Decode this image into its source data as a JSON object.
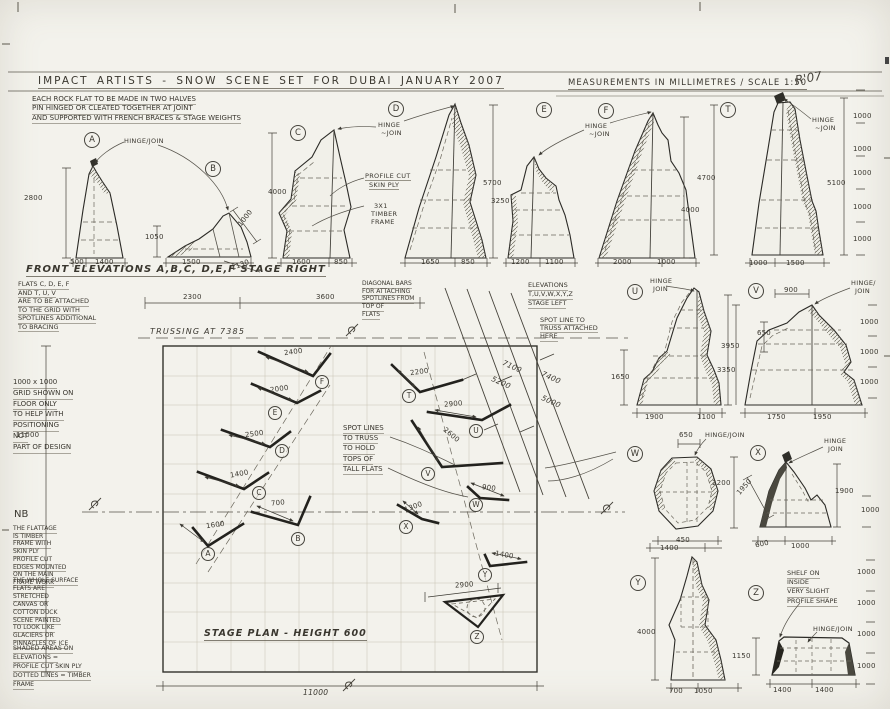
{
  "title": {
    "left": "IMPACT ARTISTS  -  SNOW SCENE SET FOR DUBAI JANUARY 2007",
    "right": "MEASUREMENTS IN MILLIMETRES / SCALE 1:50",
    "signature": "R'07"
  },
  "notes": {
    "construction": [
      "EACH ROCK FLAT TO BE MADE IN TWO HALVES",
      "PIN HINGED OR CLEATED TOGETHER AT JOINT",
      "AND SUPPORTED WITH FRENCH BRACES & STAGE WEIGHTS"
    ],
    "front_elevations": "FRONT ELEVATIONS A,B,C, D,E,F  STAGE RIGHT",
    "flats_attach": [
      "FLATS C, D, E, F",
      "AND T, U, V",
      "ARE TO BE ATTACHED",
      "TO THE GRID WITH",
      "SPOTLINES ADDITIONAL",
      "TO BRACING"
    ],
    "grid_note": [
      "1000 x 1000",
      "GRID SHOWN ON",
      "FLOOR ONLY",
      "TO HELP WITH",
      "POSITIONING",
      "NOT",
      "PART OF DESIGN"
    ],
    "nb_title": "NB",
    "nb1": [
      "THE FLATTAGE",
      "IS TIMBER",
      "FRAME WITH",
      "SKIN PLY",
      "PROFILE CUT",
      "EDGES MOUNTED",
      "ON THE MAIN",
      "FRAME WORK"
    ],
    "nb2": [
      "THE WHOLE SURFACE",
      "FLATS ARE",
      "STRETCHED",
      "CANVAS OR",
      "COTTON DUCK",
      "SCENE PAINTED",
      "TO LOOK LIKE",
      "GLACIERS OR",
      "PINNACLES OF ICE"
    ],
    "nb3": [
      "SHADED AREAS ON",
      "ELEVATIONS =",
      "PROFILE CUT SKIN PLY",
      "DOTTED LINES = TIMBER",
      "FRAME"
    ],
    "diagonal_bars": [
      "DIAGONAL BARS",
      "FOR ATTACHING",
      "SPOTLINES FROM",
      "TOP OF",
      "FLATS"
    ],
    "elevations_left": [
      "ELEVATIONS",
      "T,U,V,W,X,Y,Z",
      "STAGE LEFT"
    ],
    "spot_line": [
      "SPOT LINE TO",
      "TRUSS ATTACHED",
      "HERE"
    ],
    "spot_lines_truss": [
      "SPOT LINES",
      "TO TRUSS",
      "TO HOLD",
      "TOPS OF",
      "TALL FLATS"
    ],
    "trussing": "TRUSSING AT 7385",
    "stage_plan": "STAGE PLAN  -  HEIGHT 600",
    "shelf": [
      "SHELF ON",
      "INSIDE",
      "VERY SLIGHT",
      "PROFILE SHAPE"
    ]
  },
  "annotations": [
    {
      "n": "elev-label-a",
      "t": "A",
      "x": 84,
      "y": 132,
      "c": "circ"
    },
    {
      "n": "elev-label-b",
      "t": "B",
      "x": 205,
      "y": 161,
      "c": "circ"
    },
    {
      "n": "elev-label-c",
      "t": "C",
      "x": 290,
      "y": 125,
      "c": "circ"
    },
    {
      "n": "elev-label-d",
      "t": "D",
      "x": 388,
      "y": 101,
      "c": "circ"
    },
    {
      "n": "elev-label-e",
      "t": "E",
      "x": 536,
      "y": 102,
      "c": "circ"
    },
    {
      "n": "elev-label-f",
      "t": "F",
      "x": 598,
      "y": 103,
      "c": "circ"
    },
    {
      "n": "elev-label-t",
      "t": "T",
      "x": 720,
      "y": 102,
      "c": "circ"
    },
    {
      "n": "elev-label-u",
      "t": "U",
      "x": 627,
      "y": 284,
      "c": "circ"
    },
    {
      "n": "elev-label-v",
      "t": "V",
      "x": 748,
      "y": 283,
      "c": "circ"
    },
    {
      "n": "elev-label-w",
      "t": "W",
      "x": 627,
      "y": 446,
      "c": "circ"
    },
    {
      "n": "elev-label-x",
      "t": "X",
      "x": 750,
      "y": 445,
      "c": "circ"
    },
    {
      "n": "elev-label-y",
      "t": "Y",
      "x": 630,
      "y": 575,
      "c": "circ"
    },
    {
      "n": "elev-label-z",
      "t": "Z",
      "x": 748,
      "y": 585,
      "c": "circ"
    },
    {
      "n": "plan-label-f",
      "t": "F",
      "x": 315,
      "y": 375,
      "c": "circ-sm"
    },
    {
      "n": "plan-label-e",
      "t": "E",
      "x": 268,
      "y": 406,
      "c": "circ-sm"
    },
    {
      "n": "plan-label-d",
      "t": "D",
      "x": 275,
      "y": 444,
      "c": "circ-sm"
    },
    {
      "n": "plan-label-c",
      "t": "C",
      "x": 252,
      "y": 486,
      "c": "circ-sm"
    },
    {
      "n": "plan-label-a",
      "t": "A",
      "x": 201,
      "y": 547,
      "c": "circ-sm"
    },
    {
      "n": "plan-label-b",
      "t": "B",
      "x": 291,
      "y": 532,
      "c": "circ-sm"
    },
    {
      "n": "plan-label-t",
      "t": "T",
      "x": 402,
      "y": 389,
      "c": "circ-sm"
    },
    {
      "n": "plan-label-u",
      "t": "U",
      "x": 469,
      "y": 424,
      "c": "circ-sm"
    },
    {
      "n": "plan-label-v",
      "t": "V",
      "x": 421,
      "y": 467,
      "c": "circ-sm"
    },
    {
      "n": "plan-label-w",
      "t": "W",
      "x": 469,
      "y": 498,
      "c": "circ-sm"
    },
    {
      "n": "plan-label-x",
      "t": "X",
      "x": 399,
      "y": 520,
      "c": "circ-sm"
    },
    {
      "n": "plan-label-y",
      "t": "Y",
      "x": 478,
      "y": 568,
      "c": "circ-sm"
    },
    {
      "n": "plan-label-z",
      "t": "Z",
      "x": 470,
      "y": 630,
      "c": "circ-sm"
    },
    {
      "n": "hinge-label-ab",
      "t": "HINGE/JOIN",
      "x": 124,
      "y": 137,
      "c": "hand"
    },
    {
      "n": "hinge-label-cd-1",
      "t": "HINGE",
      "x": 378,
      "y": 121,
      "c": "hand"
    },
    {
      "n": "hinge-label-cd-2",
      "t": "~JOIN",
      "x": 381,
      "y": 129,
      "c": "hand"
    },
    {
      "n": "hinge-label-ef-1",
      "t": "HINGE",
      "x": 585,
      "y": 122,
      "c": "hand"
    },
    {
      "n": "hinge-label-ef-2",
      "t": "~JOIN",
      "x": 589,
      "y": 130,
      "c": "hand"
    },
    {
      "n": "hinge-label-t-1",
      "t": "HINGE",
      "x": 812,
      "y": 116,
      "c": "hand"
    },
    {
      "n": "hinge-label-t-2",
      "t": "~JOIN",
      "x": 815,
      "y": 124,
      "c": "hand"
    },
    {
      "n": "hinge-label-u-1",
      "t": "HINGE",
      "x": 650,
      "y": 277,
      "c": "hand"
    },
    {
      "n": "hinge-label-u-2",
      "t": "JOIN",
      "x": 653,
      "y": 285,
      "c": "hand"
    },
    {
      "n": "hinge-label-v-1",
      "t": "HINGE/",
      "x": 851,
      "y": 279,
      "c": "hand"
    },
    {
      "n": "hinge-label-v-2",
      "t": "JOIN",
      "x": 855,
      "y": 287,
      "c": "hand"
    },
    {
      "n": "hinge-label-w",
      "t": "HINGE/JOIN",
      "x": 705,
      "y": 431,
      "c": "hand"
    },
    {
      "n": "hinge-label-x-1",
      "t": "HINGE",
      "x": 824,
      "y": 437,
      "c": "hand"
    },
    {
      "n": "hinge-label-x-2",
      "t": "JOIN",
      "x": 828,
      "y": 445,
      "c": "hand"
    },
    {
      "n": "hinge-label-z",
      "t": "HINGE/JOIN",
      "x": 813,
      "y": 625,
      "c": "hand"
    },
    {
      "n": "profile-cut-label-1",
      "t": "PROFILE CUT",
      "x": 365,
      "y": 172,
      "c": "hand-ul"
    },
    {
      "n": "profile-cut-label-2",
      "t": "SKIN PLY",
      "x": 369,
      "y": 181,
      "c": "hand-ul"
    },
    {
      "n": "timber-label-1",
      "t": "3X1",
      "x": 374,
      "y": 202,
      "c": "hand"
    },
    {
      "n": "timber-label-2",
      "t": "TIMBER",
      "x": 371,
      "y": 210,
      "c": "hand"
    },
    {
      "n": "timber-label-3",
      "t": "FRAME",
      "x": 371,
      "y": 218,
      "c": "hand"
    },
    {
      "n": "dim-a-height",
      "t": "2800",
      "x": 24,
      "y": 194,
      "c": "dim"
    },
    {
      "n": "dim-a-base1",
      "t": "500",
      "x": 70,
      "y": 258,
      "c": "dim"
    },
    {
      "n": "dim-a-base2",
      "t": "1400",
      "x": 95,
      "y": 258,
      "c": "dim"
    },
    {
      "n": "dim-b-height",
      "t": "1050",
      "x": 145,
      "y": 233,
      "c": "dim"
    },
    {
      "n": "dim-b-base",
      "t": "1500",
      "x": 182,
      "y": 258,
      "c": "dim"
    },
    {
      "n": "dim-b-diag1",
      "t": "1000",
      "x": 236,
      "y": 214,
      "c": "dim",
      "r": -52
    },
    {
      "n": "dim-b-diag2",
      "t": "1130",
      "x": 231,
      "y": 261,
      "c": "dim",
      "r": -20
    },
    {
      "n": "dim-c-height",
      "t": "4000",
      "x": 268,
      "y": 188,
      "c": "dim"
    },
    {
      "n": "dim-c-base1",
      "t": "1600",
      "x": 292,
      "y": 258,
      "c": "dim"
    },
    {
      "n": "dim-c-base2",
      "t": "850",
      "x": 334,
      "y": 258,
      "c": "dim"
    },
    {
      "n": "dim-d-base1",
      "t": "1650",
      "x": 421,
      "y": 258,
      "c": "dim"
    },
    {
      "n": "dim-d-base2",
      "t": "850",
      "x": 461,
      "y": 258,
      "c": "dim"
    },
    {
      "n": "dim-d-height",
      "t": "5700",
      "x": 483,
      "y": 179,
      "c": "dim"
    },
    {
      "n": "dim-e-height",
      "t": "3250",
      "x": 491,
      "y": 197,
      "c": "dim"
    },
    {
      "n": "dim-e-base1",
      "t": "1200",
      "x": 511,
      "y": 258,
      "c": "dim"
    },
    {
      "n": "dim-e-base2",
      "t": "1100",
      "x": 545,
      "y": 258,
      "c": "dim"
    },
    {
      "n": "dim-f-base1",
      "t": "2000",
      "x": 613,
      "y": 258,
      "c": "dim"
    },
    {
      "n": "dim-f-base2",
      "t": "1000",
      "x": 657,
      "y": 258,
      "c": "dim"
    },
    {
      "n": "dim-f-height",
      "t": "4000",
      "x": 681,
      "y": 206,
      "c": "dim"
    },
    {
      "n": "dim-t-height1",
      "t": "4700",
      "x": 697,
      "y": 174,
      "c": "dim"
    },
    {
      "n": "dim-t-height2",
      "t": "5100",
      "x": 827,
      "y": 179,
      "c": "dim"
    },
    {
      "n": "dim-t-base1",
      "t": "1000",
      "x": 749,
      "y": 259,
      "c": "dim"
    },
    {
      "n": "dim-t-base2",
      "t": "1500",
      "x": 786,
      "y": 259,
      "c": "dim"
    },
    {
      "n": "scale-top-1",
      "t": "1000",
      "x": 853,
      "y": 112,
      "c": "dim"
    },
    {
      "n": "scale-top-2",
      "t": "1000",
      "x": 853,
      "y": 145,
      "c": "dim"
    },
    {
      "n": "scale-top-3",
      "t": "1000",
      "x": 853,
      "y": 169,
      "c": "dim"
    },
    {
      "n": "scale-top-4",
      "t": "1000",
      "x": 853,
      "y": 203,
      "c": "dim"
    },
    {
      "n": "scale-top-5",
      "t": "1000",
      "x": 853,
      "y": 235,
      "c": "dim"
    },
    {
      "n": "dim-span-1",
      "t": "2300",
      "x": 183,
      "y": 293,
      "c": "dim"
    },
    {
      "n": "dim-span-2",
      "t": "3600",
      "x": 316,
      "y": 293,
      "c": "dim"
    },
    {
      "n": "dim-plan-f",
      "t": "2400",
      "x": 284,
      "y": 348,
      "c": "dim",
      "r": -8
    },
    {
      "n": "dim-plan-e",
      "t": "2000",
      "x": 270,
      "y": 385,
      "c": "dim",
      "r": -8
    },
    {
      "n": "dim-plan-d",
      "t": "2500",
      "x": 245,
      "y": 430,
      "c": "dim",
      "r": -8
    },
    {
      "n": "dim-plan-c",
      "t": "1400",
      "x": 230,
      "y": 470,
      "c": "dim",
      "r": -10
    },
    {
      "n": "dim-plan-b",
      "t": "700",
      "x": 271,
      "y": 499,
      "c": "dim",
      "r": -6
    },
    {
      "n": "dim-plan-a",
      "t": "1600",
      "x": 206,
      "y": 521,
      "c": "dim",
      "r": -8
    },
    {
      "n": "dim-plan-t",
      "t": "2200",
      "x": 410,
      "y": 368,
      "c": "dim",
      "r": -8
    },
    {
      "n": "dim-plan-u",
      "t": "2900",
      "x": 444,
      "y": 400,
      "c": "dim",
      "r": -5
    },
    {
      "n": "dim-plan-v",
      "t": "2600",
      "x": 442,
      "y": 431,
      "c": "dim",
      "r": 40
    },
    {
      "n": "dim-plan-w",
      "t": "900",
      "x": 482,
      "y": 484,
      "c": "dim",
      "r": 8
    },
    {
      "n": "dim-plan-x",
      "t": "1300",
      "x": 404,
      "y": 503,
      "c": "dim",
      "r": -20
    },
    {
      "n": "dim-plan-y",
      "t": "1400",
      "x": 495,
      "y": 551,
      "c": "dim",
      "r": 10
    },
    {
      "n": "dim-plan-z",
      "t": "2900",
      "x": 455,
      "y": 581,
      "c": "dim",
      "r": -4
    },
    {
      "n": "dim-spotline-1",
      "t": "7100",
      "x": 502,
      "y": 362,
      "c": "dim-it",
      "r": 24
    },
    {
      "n": "dim-spotline-2",
      "t": "5200",
      "x": 491,
      "y": 378,
      "c": "dim-it",
      "r": 24
    },
    {
      "n": "dim-spotline-3",
      "t": "7400",
      "x": 541,
      "y": 373,
      "c": "dim-it",
      "r": 24
    },
    {
      "n": "dim-spotline-4",
      "t": "5000",
      "x": 541,
      "y": 397,
      "c": "dim-it",
      "r": 24
    },
    {
      "n": "dim-plan-width-left",
      "t": "11000",
      "x": 16,
      "y": 431,
      "c": "dim"
    },
    {
      "n": "dim-plan-width-bottom",
      "t": "11000",
      "x": 303,
      "y": 688,
      "c": "dim-it"
    },
    {
      "n": "dim-u-left",
      "t": "1650",
      "x": 611,
      "y": 373,
      "c": "dim"
    },
    {
      "n": "dim-u-height",
      "t": "3950",
      "x": 721,
      "y": 342,
      "c": "dim"
    },
    {
      "n": "dim-v-height",
      "t": "3350",
      "x": 717,
      "y": 366,
      "c": "dim"
    },
    {
      "n": "dim-u-base1",
      "t": "1900",
      "x": 645,
      "y": 413,
      "c": "dim"
    },
    {
      "n": "dim-u-base2",
      "t": "1100",
      "x": 697,
      "y": 413,
      "c": "dim"
    },
    {
      "n": "dim-v-top",
      "t": "900",
      "x": 784,
      "y": 286,
      "c": "dim"
    },
    {
      "n": "dim-v-left",
      "t": "650",
      "x": 757,
      "y": 329,
      "c": "dim"
    },
    {
      "n": "dim-v-base1",
      "t": "1750",
      "x": 767,
      "y": 413,
      "c": "dim"
    },
    {
      "n": "dim-v-base2",
      "t": "1950",
      "x": 813,
      "y": 413,
      "c": "dim"
    },
    {
      "n": "scale-mid-1",
      "t": "1000",
      "x": 860,
      "y": 318,
      "c": "dim"
    },
    {
      "n": "scale-mid-2",
      "t": "1000",
      "x": 860,
      "y": 348,
      "c": "dim"
    },
    {
      "n": "scale-mid-3",
      "t": "1000",
      "x": 860,
      "y": 378,
      "c": "dim"
    },
    {
      "n": "dim-w-top",
      "t": "650",
      "x": 679,
      "y": 431,
      "c": "dim"
    },
    {
      "n": "dim-w-height",
      "t": "2200",
      "x": 712,
      "y": 479,
      "c": "dim"
    },
    {
      "n": "dim-w-base1",
      "t": "450",
      "x": 676,
      "y": 536,
      "c": "dim"
    },
    {
      "n": "dim-w-base2",
      "t": "1400",
      "x": 660,
      "y": 544,
      "c": "dim"
    },
    {
      "n": "dim-x-diag",
      "t": "1950",
      "x": 735,
      "y": 483,
      "c": "dim",
      "r": -48
    },
    {
      "n": "dim-x-height",
      "t": "1900",
      "x": 835,
      "y": 487,
      "c": "dim"
    },
    {
      "n": "dim-x-base1",
      "t": "600",
      "x": 755,
      "y": 540,
      "c": "dim",
      "r": -12
    },
    {
      "n": "dim-x-base2",
      "t": "1000",
      "x": 791,
      "y": 542,
      "c": "dim"
    },
    {
      "n": "scale-x-1",
      "t": "1000",
      "x": 861,
      "y": 506,
      "c": "dim"
    },
    {
      "n": "dim-y-height",
      "t": "4000",
      "x": 637,
      "y": 628,
      "c": "dim"
    },
    {
      "n": "dim-y-base1",
      "t": "700",
      "x": 669,
      "y": 687,
      "c": "dim"
    },
    {
      "n": "dim-y-base2",
      "t": "1050",
      "x": 694,
      "y": 687,
      "c": "dim"
    },
    {
      "n": "dim-z-height",
      "t": "1150",
      "x": 732,
      "y": 652,
      "c": "dim"
    },
    {
      "n": "dim-z-base1",
      "t": "1400",
      "x": 773,
      "y": 686,
      "c": "dim"
    },
    {
      "n": "dim-z-base2",
      "t": "1400",
      "x": 815,
      "y": 686,
      "c": "dim"
    },
    {
      "n": "scale-low-1",
      "t": "1000",
      "x": 857,
      "y": 568,
      "c": "dim"
    },
    {
      "n": "scale-low-2",
      "t": "1000",
      "x": 857,
      "y": 599,
      "c": "dim"
    },
    {
      "n": "scale-low-3",
      "t": "1000",
      "x": 857,
      "y": 630,
      "c": "dim"
    },
    {
      "n": "scale-low-4",
      "t": "1000",
      "x": 857,
      "y": 662,
      "c": "dim"
    }
  ]
}
